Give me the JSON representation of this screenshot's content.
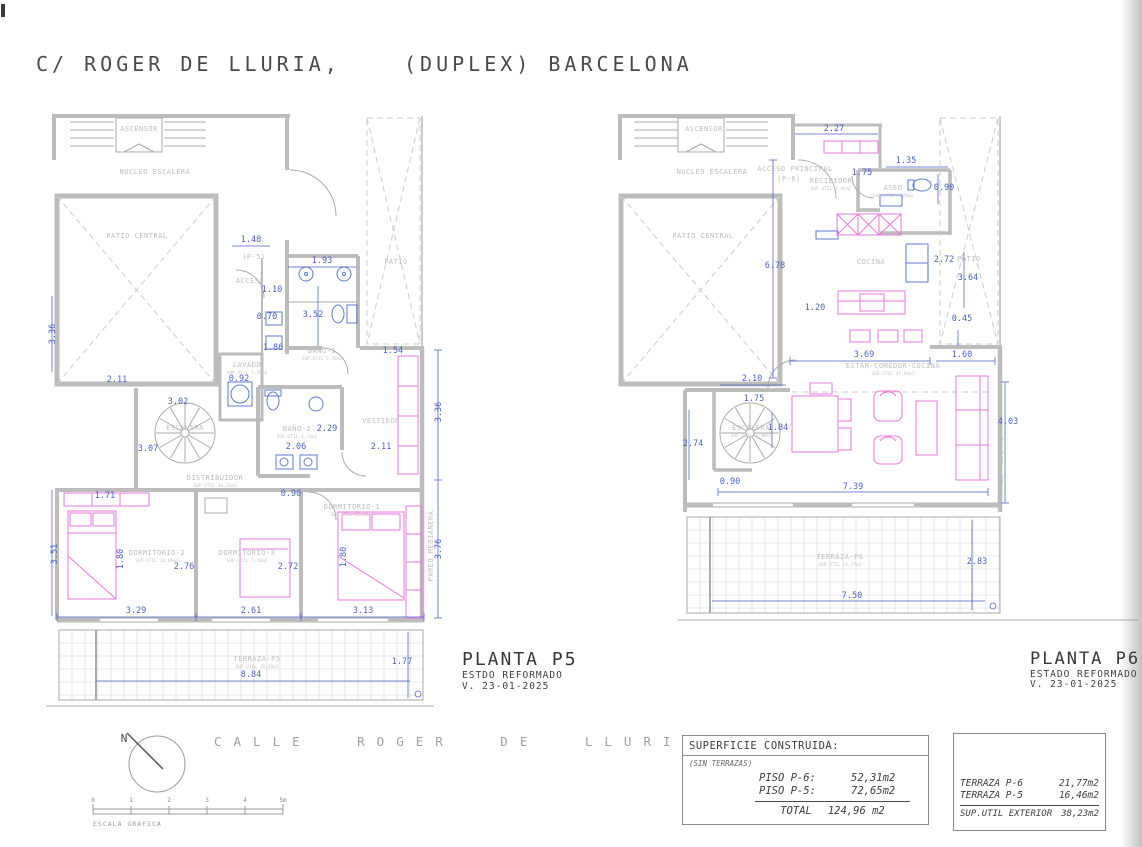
{
  "page": {
    "title_left": "C/ ROGER DE LLURIA,",
    "title_right": "(DUPLEX) BARCELONA"
  },
  "colors": {
    "dimension": "#4a63c8",
    "furniture": "#e878de",
    "fixture": "#5b7ad0",
    "wall": "#b5b5b5",
    "room_label": "#bdbdbd",
    "text": "#3d3d3d"
  },
  "plans": {
    "p5": {
      "name": "PLANTA P5",
      "subtitle": "ESTDO REFORMADO",
      "version": "V. 23-01-2025",
      "rooms": [
        {
          "t": "ASCENSOR",
          "x": 139,
          "y": 131
        },
        {
          "t": "NUCLEO ESCALERA",
          "x": 155,
          "y": 174
        },
        {
          "t": "PATIO CENTRAL",
          "x": 137,
          "y": 238
        },
        {
          "t": "(P-5)",
          "x": 254,
          "y": 259
        },
        {
          "t": "ACCESO",
          "x": 250,
          "y": 283
        },
        {
          "t": "PATIO",
          "x": 396,
          "y": 264
        },
        {
          "t": "BAÑO-1",
          "x": 322,
          "y": 353,
          "sub": "SUP.UTIL 5,70m2"
        },
        {
          "t": "LAVADO",
          "x": 247,
          "y": 367,
          "sub": "SUP.UTIL 1,38m2"
        },
        {
          "t": "ESCALERA",
          "x": 185,
          "y": 430
        },
        {
          "t": "BAÑO-2",
          "x": 297,
          "y": 431,
          "sub": "SUP.UTIL 4,70m2"
        },
        {
          "t": "DISTRIBUIDOR",
          "x": 215,
          "y": 480,
          "sub": "SUP.UTIL 10,35m2"
        },
        {
          "t": "VESTIDOR",
          "x": 381,
          "y": 423
        },
        {
          "t": "DORMITORIO-1",
          "x": 352,
          "y": 509,
          "sub": "SUP.UTIL 15,30m2"
        },
        {
          "t": "DORMITORIO-2",
          "x": 157,
          "y": 555,
          "sub": "SUP.UTIL 10,86m2"
        },
        {
          "t": "DORMITORIO-3",
          "x": 247,
          "y": 555,
          "sub": "SUP.UTIL 7,10m2"
        },
        {
          "t": "TERRAZA-P5",
          "x": 257,
          "y": 661,
          "sub": "SUP.UTIL 16,46m2"
        },
        {
          "t": "PARED MEDIANERA",
          "x": 433,
          "y": 546,
          "r": -90
        }
      ],
      "dims": [
        {
          "t": "1.48",
          "x": 251,
          "y": 242
        },
        {
          "t": "1.93",
          "x": 322,
          "y": 263
        },
        {
          "t": "1.10",
          "x": 272,
          "y": 292
        },
        {
          "t": "0.70",
          "x": 267,
          "y": 319
        },
        {
          "t": "3.52",
          "x": 313,
          "y": 317
        },
        {
          "t": "1.86",
          "x": 273,
          "y": 350
        },
        {
          "t": "3.36",
          "x": 55,
          "y": 334,
          "r": -90
        },
        {
          "t": "2.11",
          "x": 117,
          "y": 382
        },
        {
          "t": "0.92",
          "x": 239,
          "y": 381
        },
        {
          "t": "3.02",
          "x": 178,
          "y": 404
        },
        {
          "t": "3.07",
          "x": 148,
          "y": 451
        },
        {
          "t": "2.29",
          "x": 327,
          "y": 431
        },
        {
          "t": "2.06",
          "x": 296,
          "y": 449
        },
        {
          "t": "0.90",
          "x": 291,
          "y": 496
        },
        {
          "t": "2.11",
          "x": 381,
          "y": 449
        },
        {
          "t": "1.54",
          "x": 393,
          "y": 353
        },
        {
          "t": "1.71",
          "x": 105,
          "y": 498
        },
        {
          "t": "3.51",
          "x": 57,
          "y": 554,
          "r": -90
        },
        {
          "t": "1.80",
          "x": 123,
          "y": 559,
          "r": -90
        },
        {
          "t": "2.76",
          "x": 184,
          "y": 569
        },
        {
          "t": "2.72",
          "x": 288,
          "y": 569
        },
        {
          "t": "1.80",
          "x": 346,
          "y": 557,
          "r": -90
        },
        {
          "t": "3.29",
          "x": 136,
          "y": 613
        },
        {
          "t": "2.61",
          "x": 251,
          "y": 613
        },
        {
          "t": "3.13",
          "x": 363,
          "y": 613
        },
        {
          "t": "3.36",
          "x": 441,
          "y": 412,
          "r": -90
        },
        {
          "t": "3.76",
          "x": 441,
          "y": 549,
          "r": -90
        },
        {
          "t": "1.77",
          "x": 402,
          "y": 664
        },
        {
          "t": "8.84",
          "x": 251,
          "y": 677
        }
      ]
    },
    "p6": {
      "name": "PLANTA P6",
      "subtitle": "ESTADO REFORMADO",
      "version": "V. 23-01-2025",
      "rooms": [
        {
          "t": "ASCENSOR",
          "x": 704,
          "y": 131
        },
        {
          "t": "NUCLEO ESCALERA",
          "x": 712,
          "y": 174
        },
        {
          "t": "ACCESO PRINCIPAL",
          "x": 795,
          "y": 171
        },
        {
          "t": "(P-6)",
          "x": 789,
          "y": 181
        },
        {
          "t": "RECIBIDOR",
          "x": 831,
          "y": 183,
          "sub": "SUP.UTIL 2,80m2"
        },
        {
          "t": "ASEO",
          "x": 893,
          "y": 190,
          "sub": "SUP.UTIL 1,70m2"
        },
        {
          "t": "PATIO CENTRAL",
          "x": 703,
          "y": 238
        },
        {
          "t": "COCINA",
          "x": 871,
          "y": 264
        },
        {
          "t": "PATIO",
          "x": 969,
          "y": 261
        },
        {
          "t": "ESTAR-COMEDOR-COCINA",
          "x": 893,
          "y": 368,
          "sub": "SUP.UTIL 37,84m2"
        },
        {
          "t": "ESCALERA",
          "x": 751,
          "y": 430,
          "sub": "SUP.UTIL 3,40m2"
        },
        {
          "t": "TERRAZA-P6",
          "x": 840,
          "y": 559,
          "sub": "SUP.UTIL 21,77m2"
        },
        {
          "t": "PARED MEDIANERA",
          "x": 1003,
          "y": 462,
          "r": -90
        }
      ],
      "dims": [
        {
          "t": "2.27",
          "x": 834,
          "y": 131
        },
        {
          "t": "1.35",
          "x": 906,
          "y": 163
        },
        {
          "t": "1.75",
          "x": 862,
          "y": 175
        },
        {
          "t": "0.90",
          "x": 944,
          "y": 190
        },
        {
          "t": "6.78",
          "x": 775,
          "y": 268
        },
        {
          "t": "1.20",
          "x": 815,
          "y": 310
        },
        {
          "t": "2.72",
          "x": 944,
          "y": 262
        },
        {
          "t": "3.64",
          "x": 968,
          "y": 280
        },
        {
          "t": "0.45",
          "x": 962,
          "y": 321
        },
        {
          "t": "3.69",
          "x": 864,
          "y": 357
        },
        {
          "t": "1.60",
          "x": 962,
          "y": 357
        },
        {
          "t": "2.10",
          "x": 752,
          "y": 381
        },
        {
          "t": "1.75",
          "x": 754,
          "y": 401
        },
        {
          "t": "1.84",
          "x": 778,
          "y": 430
        },
        {
          "t": "2.74",
          "x": 693,
          "y": 446
        },
        {
          "t": "0.90",
          "x": 730,
          "y": 484
        },
        {
          "t": "7.39",
          "x": 853,
          "y": 489
        },
        {
          "t": "4.03",
          "x": 1008,
          "y": 424
        },
        {
          "t": "7.50",
          "x": 852,
          "y": 598
        },
        {
          "t": "2.83",
          "x": 977,
          "y": 564
        }
      ]
    }
  },
  "tables": {
    "construida": {
      "title": "SUPERFICIE CONSTRUIDA:",
      "note": "(SIN TERRAZAS)",
      "rows": [
        {
          "label": "PISO P-6:",
          "value": "52,31m2"
        },
        {
          "label": "PISO P-5:",
          "value": "72,65m2"
        }
      ],
      "total_label": "TOTAL",
      "total_value": "124,96 m2"
    },
    "exterior": {
      "rows": [
        {
          "label": "TERRAZA P-6",
          "value": "21,77m2"
        },
        {
          "label": "TERRAZA P-5",
          "value": "16,46m2"
        }
      ],
      "total_label": "SUP.UTIL EXTERIOR",
      "total_value": "38,23m2"
    }
  },
  "street": {
    "name": "CALLE ROGER DE LLURIA",
    "compass_label": "N",
    "scale_caption": "ESCALA GRAFICA",
    "scale_ticks": [
      "0",
      "1",
      "2",
      "3",
      "4",
      "5m"
    ]
  }
}
